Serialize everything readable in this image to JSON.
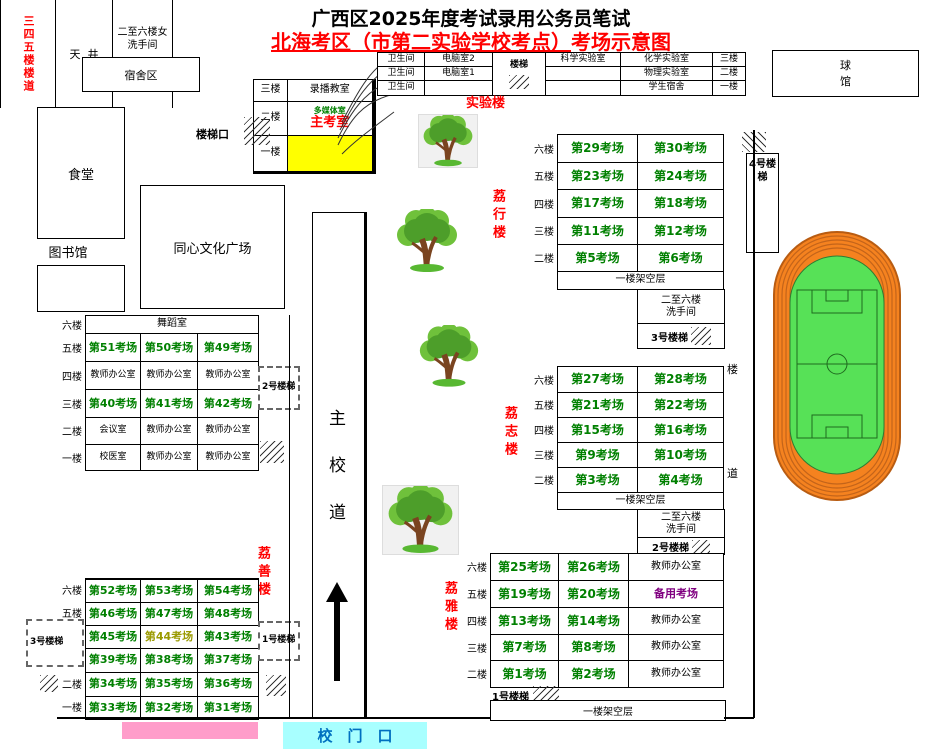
{
  "title": {
    "line1": "广西区2025年度考试录用公务员笔试",
    "line2_main": "北海考区（市第二实验学校考点）",
    "line2_tail": "考场示意图"
  },
  "campus": {
    "dorm": "宿舍区",
    "canteen": "食堂",
    "library": "图书馆",
    "plaza": "同心文化广场",
    "ball_hall_1": "球",
    "ball_hall_2": "馆",
    "stair_exit": "楼梯口",
    "gate": "校　门　口",
    "road_1": "主",
    "road_2": "校",
    "road_3": "道",
    "side_road_1": "楼",
    "side_road_2": "道"
  },
  "recording": {
    "f3": "三楼",
    "r3": "录播教室",
    "f2": "二楼",
    "r2a": "多媒体室",
    "r2b": "主考室",
    "f1": "一楼",
    "r1": ""
  },
  "lab": {
    "name": "实验楼",
    "stair": "楼梯",
    "rows": [
      {
        "wc": "卫生间",
        "c1": "电脑室2",
        "c3": "科学实验室",
        "c4": "化学实验室",
        "floor": "三楼"
      },
      {
        "wc": "卫生间",
        "c1": "电脑室1",
        "c3": "",
        "c4": "物理实验室",
        "floor": "二楼"
      },
      {
        "wc": "卫生间",
        "c1": "",
        "c3": "",
        "c4": "学生宿舍",
        "floor": "一楼"
      }
    ]
  },
  "lixing": {
    "name": "荔行楼",
    "stair4": "4号楼梯",
    "stair3": "3号楼梯",
    "footer": "一楼架空层",
    "wash_1": "二至六楼",
    "wash_2": "洗手间",
    "floors": [
      {
        "floor": "六楼",
        "r1": "第29考场",
        "r2": "第30考场"
      },
      {
        "floor": "五楼",
        "r1": "第23考场",
        "r2": "第24考场"
      },
      {
        "floor": "四楼",
        "r1": "第17考场",
        "r2": "第18考场"
      },
      {
        "floor": "三楼",
        "r1": "第11考场",
        "r2": "第12考场"
      },
      {
        "floor": "二楼",
        "r1": "第5考场",
        "r2": "第6考场"
      }
    ]
  },
  "lizhi": {
    "name": "荔志楼",
    "stair2": "2号楼梯",
    "footer": "一楼架空层",
    "wash_1": "二至六楼",
    "wash_2": "洗手间",
    "floors": [
      {
        "floor": "六楼",
        "r1": "第27考场",
        "r2": "第28考场"
      },
      {
        "floor": "五楼",
        "r1": "第21考场",
        "r2": "第22考场"
      },
      {
        "floor": "四楼",
        "r1": "第15考场",
        "r2": "第16考场"
      },
      {
        "floor": "三楼",
        "r1": "第9考场",
        "r2": "第10考场"
      },
      {
        "floor": "二楼",
        "r1": "第3考场",
        "r2": "第4考场"
      }
    ]
  },
  "liya": {
    "name": "荔雅楼",
    "stair1": "1号楼梯",
    "footer": "一楼架空层",
    "floors": [
      {
        "floor": "六楼",
        "r1": "第25考场",
        "r2": "第26考场",
        "r3": "教师办公室"
      },
      {
        "floor": "五楼",
        "r1": "第19考场",
        "r2": "第20考场",
        "r3": "备用考场"
      },
      {
        "floor": "四楼",
        "r1": "第13考场",
        "r2": "第14考场",
        "r3": "教师办公室"
      },
      {
        "floor": "三楼",
        "r1": "第7考场",
        "r2": "第8考场",
        "r3": "教师办公室"
      },
      {
        "floor": "二楼",
        "r1": "第1考场",
        "r2": "第2考场",
        "r3": "教师办公室"
      }
    ]
  },
  "lishan": {
    "name": "荔善楼",
    "stair2_box": "2号楼梯",
    "stair1_box": "1号楼梯",
    "stair3_box": "3号楼梯",
    "upper": [
      {
        "floor": "六楼",
        "span": "舞蹈室"
      },
      {
        "floor": "五楼",
        "c1": "第51考场",
        "c2": "第50考场",
        "c3": "第49考场"
      },
      {
        "floor": "四楼",
        "c1": "教师办公室",
        "c2": "教师办公室",
        "c3": "教师办公室"
      },
      {
        "floor": "三楼",
        "c1": "第40考场",
        "c2": "第41考场",
        "c3": "第42考场"
      },
      {
        "floor": "二楼",
        "c1": "会议室",
        "c2": "教师办公室",
        "c3": "教师办公室"
      },
      {
        "floor": "一楼",
        "c1": "校医室",
        "c2": "教师办公室",
        "c3": "教师办公室"
      }
    ],
    "mid": {
      "corridor": "三四五楼楼道",
      "well": "天  井",
      "wash_1": "二至六楼女",
      "wash_2": "洗手间"
    },
    "lower": [
      {
        "floor": "六楼",
        "c1": "第52考场",
        "c2": "第53考场",
        "c3": "第54考场"
      },
      {
        "floor": "五楼",
        "c1": "第46考场",
        "c2": "第47考场",
        "c3": "第48考场"
      },
      {
        "floor": "四楼",
        "c1": "第45考场",
        "c2": "第44考场",
        "c3": "第43考场"
      },
      {
        "floor": "三楼",
        "c1": "第39考场",
        "c2": "第38考场",
        "c3": "第37考场"
      },
      {
        "floor": "二楼",
        "c1": "第34考场",
        "c2": "第35考场",
        "c3": "第36考场"
      },
      {
        "floor": "一楼",
        "c1": "第33考场",
        "c2": "第32考场",
        "c3": "第31考场"
      }
    ]
  },
  "colors": {
    "exam_text": "#008000",
    "building_label": "#ff0000",
    "backup_room": "#800080",
    "room44": "#9a9a00",
    "main_exam_room_bg": "#ffff00",
    "gate_text": "#0070c0",
    "gate_bg": "#a8ffff",
    "pink_bar": "#ff9dca",
    "track": "#f5821f",
    "field": "#57e157"
  }
}
